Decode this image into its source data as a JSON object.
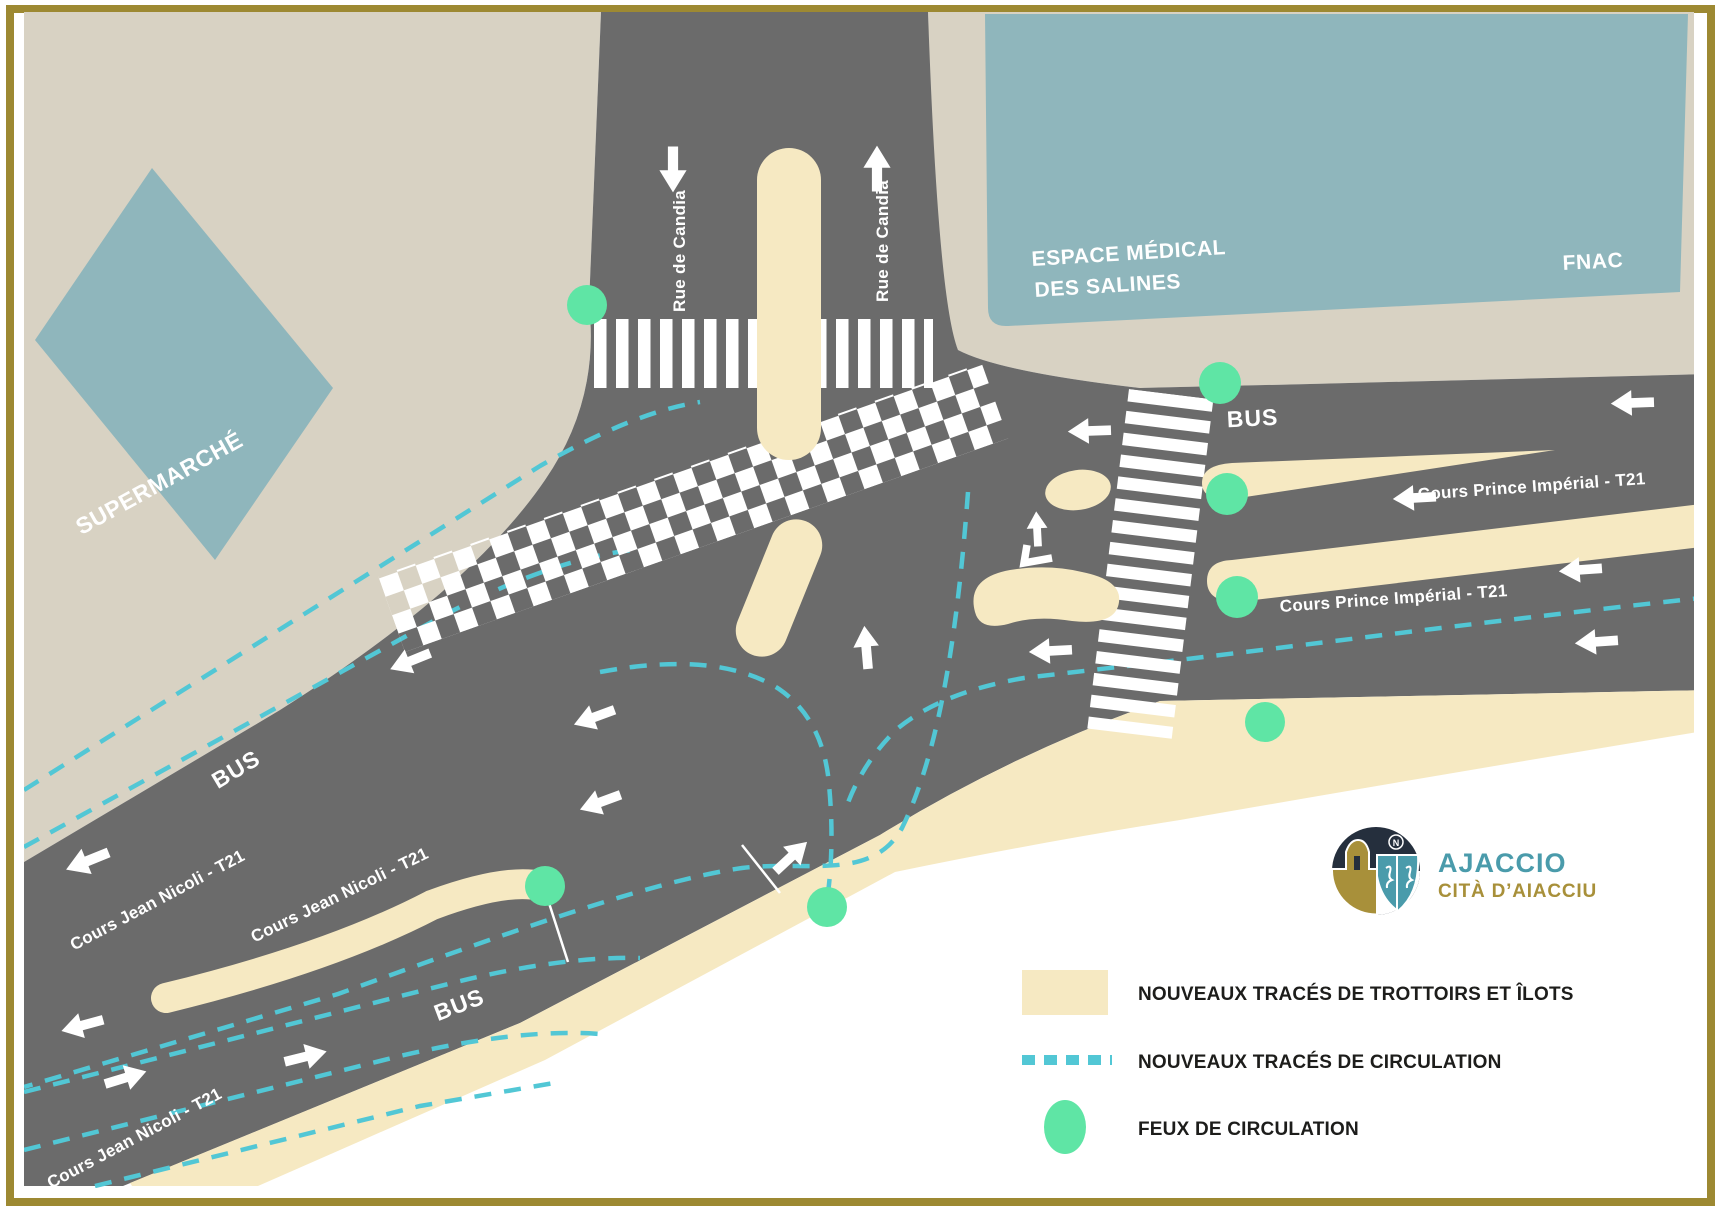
{
  "map": {
    "buildings": {
      "supermarket": "SUPERMARCHÉ",
      "medical_line1": "ESPACE MÉDICAL",
      "medical_line2": "DES SALINES",
      "fnac": "FNAC"
    },
    "streets": {
      "rue_de_candia": "Rue de Candia",
      "cours_prince_imperial": "Cours Prince Impérial - T21",
      "cours_jean_nicoli": "Cours Jean Nicoli - T21",
      "bus_lane": "BUS"
    },
    "colors": {
      "road": "#6b6b6b",
      "land": "#d8d2c3",
      "building": "#8fb6bc",
      "sidewalk_island": "#f6e9c2",
      "circulation_dash": "#52c7d5",
      "traffic_light": "#5fe5a5",
      "frame_gold": "#9d8932",
      "marking_white": "#ffffff"
    }
  },
  "legend": {
    "items": [
      {
        "swatch": "sidewalk-swatch",
        "label": "NOUVEAUX TRACÉS DE TROTTOIRS ET ÎLOTS"
      },
      {
        "swatch": "dashed-swatch",
        "label": "NOUVEAUX TRACÉS DE CIRCULATION"
      },
      {
        "swatch": "light-swatch",
        "label": "FEUX DE CIRCULATION"
      }
    ]
  },
  "logo": {
    "title": "AJACCIO",
    "subtitle": "CITÀ D’AIACCIU",
    "compass": "N"
  }
}
